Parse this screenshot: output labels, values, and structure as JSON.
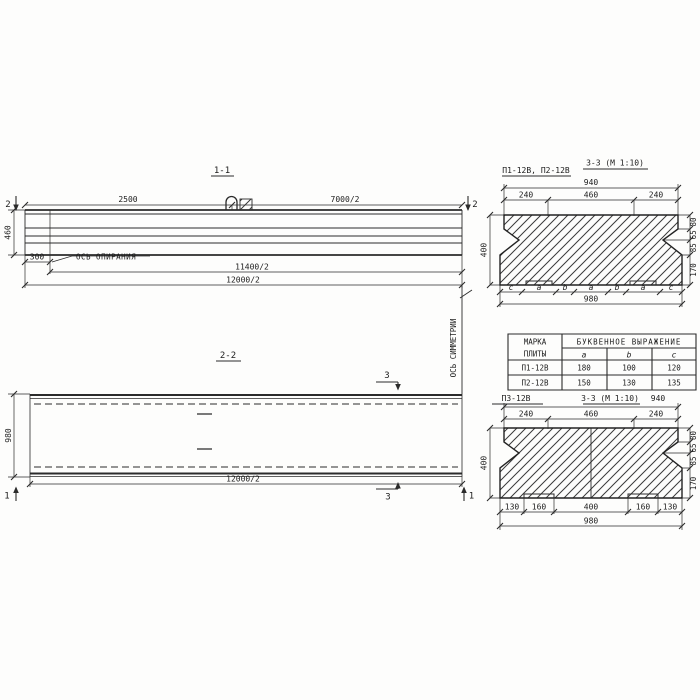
{
  "s11": {
    "title": "1-1",
    "dim_top_left": "2500",
    "dim_top_right": "7000/2",
    "dim_height": "460",
    "dim_300": "300",
    "support_axis_label": "ОСЬ ОПИРАНИЯ",
    "dim_11400": "11400/2",
    "dim_12000": "12000/2",
    "marker_left": "2",
    "marker_right": "2"
  },
  "s22": {
    "title": "2-2",
    "dim_height": "980",
    "dim_bottom": "12000/2",
    "marker_top": "3",
    "marker_bottom": "3",
    "marker_left": "1",
    "marker_right": "1"
  },
  "axis_of_symmetry": "ОСЬ СИММЕТРИИ",
  "sec_top": {
    "label": "П1-12В, П2-12В",
    "title": "3-3 (М 1:10)",
    "dim_940": "940",
    "dim_240l": "240",
    "dim_460": "460",
    "dim_240r": "240",
    "dim_400": "400",
    "right": [
      "80",
      "65",
      "85",
      "170"
    ],
    "letters": [
      "c",
      "a",
      "b",
      "a",
      "b",
      "a",
      "c"
    ],
    "dim_980": "980"
  },
  "table": {
    "h_mark1": "МАРКА",
    "h_mark2": "ПЛИТЫ",
    "h_span": "БУКВЕННОЕ ВЫРАЖЕНИЕ",
    "cols": [
      "a",
      "b",
      "c"
    ],
    "rows": [
      [
        "П1-12В",
        "180",
        "100",
        "120"
      ],
      [
        "П2-12В",
        "150",
        "130",
        "135"
      ]
    ]
  },
  "sec_bot": {
    "label": "П3-12В",
    "title": "3-3 (М 1:10)",
    "dim_940": "940",
    "dim_240l": "240",
    "dim_460": "460",
    "dim_240r": "240",
    "dim_400": "400",
    "right": [
      "80",
      "65",
      "85",
      "170"
    ],
    "bottom": [
      "130",
      "160",
      "400",
      "160",
      "130"
    ],
    "dim_980": "980"
  }
}
